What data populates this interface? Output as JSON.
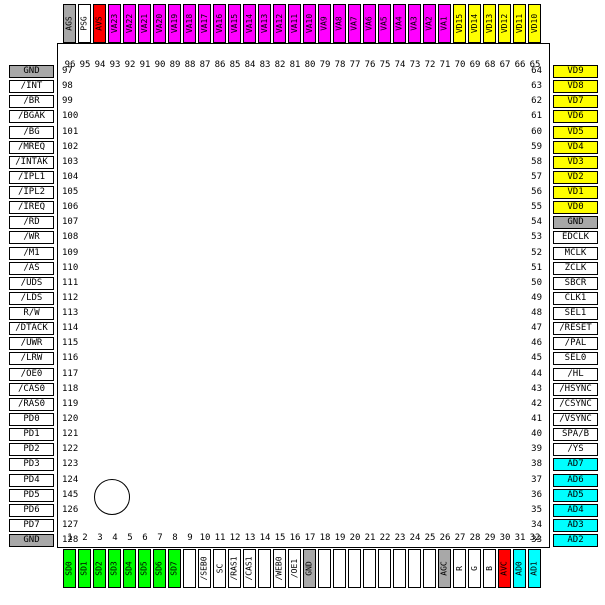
{
  "colors": {
    "gray": "#a8a8a8",
    "white": "#ffffff",
    "red": "#ff0000",
    "magenta": "#ff00ff",
    "yellow": "#ffff00",
    "green": "#00ff00",
    "cyan": "#00ffff"
  },
  "pins": {
    "top": [
      {
        "num": "96",
        "label": "AGS",
        "color": "gray"
      },
      {
        "num": "95",
        "label": "PSG",
        "color": "white"
      },
      {
        "num": "94",
        "label": "AVS",
        "color": "red"
      },
      {
        "num": "93",
        "label": "VA23",
        "color": "magenta"
      },
      {
        "num": "92",
        "label": "VA22",
        "color": "magenta"
      },
      {
        "num": "91",
        "label": "VA21",
        "color": "magenta"
      },
      {
        "num": "90",
        "label": "VA20",
        "color": "magenta"
      },
      {
        "num": "89",
        "label": "VA19",
        "color": "magenta"
      },
      {
        "num": "88",
        "label": "VA18",
        "color": "magenta"
      },
      {
        "num": "87",
        "label": "VA17",
        "color": "magenta"
      },
      {
        "num": "86",
        "label": "VA16",
        "color": "magenta"
      },
      {
        "num": "85",
        "label": "VA15",
        "color": "magenta"
      },
      {
        "num": "84",
        "label": "VA14",
        "color": "magenta"
      },
      {
        "num": "83",
        "label": "VA13",
        "color": "magenta"
      },
      {
        "num": "82",
        "label": "VA12",
        "color": "magenta"
      },
      {
        "num": "81",
        "label": "VA11",
        "color": "magenta"
      },
      {
        "num": "80",
        "label": "VA10",
        "color": "magenta"
      },
      {
        "num": "79",
        "label": "VA9",
        "color": "magenta"
      },
      {
        "num": "78",
        "label": "VA8",
        "color": "magenta"
      },
      {
        "num": "77",
        "label": "VA7",
        "color": "magenta"
      },
      {
        "num": "76",
        "label": "VA6",
        "color": "magenta"
      },
      {
        "num": "75",
        "label": "VA5",
        "color": "magenta"
      },
      {
        "num": "74",
        "label": "VA4",
        "color": "magenta"
      },
      {
        "num": "73",
        "label": "VA3",
        "color": "magenta"
      },
      {
        "num": "72",
        "label": "VA2",
        "color": "magenta"
      },
      {
        "num": "71",
        "label": "VA1",
        "color": "magenta"
      },
      {
        "num": "70",
        "label": "VD15",
        "color": "yellow"
      },
      {
        "num": "69",
        "label": "VD14",
        "color": "yellow"
      },
      {
        "num": "68",
        "label": "VD13",
        "color": "yellow"
      },
      {
        "num": "67",
        "label": "VD12",
        "color": "yellow"
      },
      {
        "num": "66",
        "label": "VD11",
        "color": "yellow"
      },
      {
        "num": "65",
        "label": "VD10",
        "color": "yellow"
      }
    ],
    "left": [
      {
        "num": "97",
        "label": "GND",
        "color": "gray"
      },
      {
        "num": "98",
        "label": "/INT",
        "color": "white"
      },
      {
        "num": "99",
        "label": "/BR",
        "color": "white"
      },
      {
        "num": "100",
        "label": "/BGAK",
        "color": "white"
      },
      {
        "num": "101",
        "label": "/BG",
        "color": "white"
      },
      {
        "num": "102",
        "label": "/MREQ",
        "color": "white"
      },
      {
        "num": "103",
        "label": "/INTAK",
        "color": "white"
      },
      {
        "num": "104",
        "label": "/IPL1",
        "color": "white"
      },
      {
        "num": "105",
        "label": "/IPL2",
        "color": "white"
      },
      {
        "num": "106",
        "label": "/IREQ",
        "color": "white"
      },
      {
        "num": "107",
        "label": "/RD",
        "color": "white"
      },
      {
        "num": "108",
        "label": "/WR",
        "color": "white"
      },
      {
        "num": "109",
        "label": "/M1",
        "color": "white"
      },
      {
        "num": "110",
        "label": "/AS",
        "color": "white"
      },
      {
        "num": "111",
        "label": "/UDS",
        "color": "white"
      },
      {
        "num": "112",
        "label": "/LDS",
        "color": "white"
      },
      {
        "num": "113",
        "label": "R/W",
        "color": "white"
      },
      {
        "num": "114",
        "label": "/DTACK",
        "color": "white"
      },
      {
        "num": "115",
        "label": "/UWR",
        "color": "white"
      },
      {
        "num": "116",
        "label": "/LRW",
        "color": "white"
      },
      {
        "num": "117",
        "label": "/OE0",
        "color": "white"
      },
      {
        "num": "118",
        "label": "/CAS0",
        "color": "white"
      },
      {
        "num": "119",
        "label": "/RAS0",
        "color": "white"
      },
      {
        "num": "120",
        "label": "PD0",
        "color": "white"
      },
      {
        "num": "121",
        "label": "PD1",
        "color": "white"
      },
      {
        "num": "122",
        "label": "PD2",
        "color": "white"
      },
      {
        "num": "123",
        "label": "PD3",
        "color": "white"
      },
      {
        "num": "124",
        "label": "PD4",
        "color": "white"
      },
      {
        "num": "145",
        "label": "PD5",
        "color": "white"
      },
      {
        "num": "126",
        "label": "PD6",
        "color": "white"
      },
      {
        "num": "127",
        "label": "PD7",
        "color": "white"
      },
      {
        "num": "128",
        "label": "GND",
        "color": "gray"
      }
    ],
    "right": [
      {
        "num": "64",
        "label": "VD9",
        "color": "yellow"
      },
      {
        "num": "63",
        "label": "VD8",
        "color": "yellow"
      },
      {
        "num": "62",
        "label": "VD7",
        "color": "yellow"
      },
      {
        "num": "61",
        "label": "VD6",
        "color": "yellow"
      },
      {
        "num": "60",
        "label": "VD5",
        "color": "yellow"
      },
      {
        "num": "59",
        "label": "VD4",
        "color": "yellow"
      },
      {
        "num": "58",
        "label": "VD3",
        "color": "yellow"
      },
      {
        "num": "57",
        "label": "VD2",
        "color": "yellow"
      },
      {
        "num": "56",
        "label": "VD1",
        "color": "yellow"
      },
      {
        "num": "55",
        "label": "VD0",
        "color": "yellow"
      },
      {
        "num": "54",
        "label": "GND",
        "color": "gray"
      },
      {
        "num": "53",
        "label": "EDCLK",
        "color": "white"
      },
      {
        "num": "52",
        "label": "MCLK",
        "color": "white"
      },
      {
        "num": "51",
        "label": "ZCLK",
        "color": "white"
      },
      {
        "num": "50",
        "label": "SBCR",
        "color": "white"
      },
      {
        "num": "49",
        "label": "CLK1",
        "color": "white"
      },
      {
        "num": "48",
        "label": "SEL1",
        "color": "white"
      },
      {
        "num": "47",
        "label": "/RESET",
        "color": "white"
      },
      {
        "num": "46",
        "label": "/PAL",
        "color": "white"
      },
      {
        "num": "45",
        "label": "SEL0",
        "color": "white"
      },
      {
        "num": "44",
        "label": "/HL",
        "color": "white"
      },
      {
        "num": "43",
        "label": "/HSYNC",
        "color": "white"
      },
      {
        "num": "42",
        "label": "/CSYNC",
        "color": "white"
      },
      {
        "num": "41",
        "label": "/VSYNC",
        "color": "white"
      },
      {
        "num": "40",
        "label": "SPA/B",
        "color": "white"
      },
      {
        "num": "39",
        "label": "/YS",
        "color": "white"
      },
      {
        "num": "38",
        "label": "AD7",
        "color": "cyan"
      },
      {
        "num": "37",
        "label": "AD6",
        "color": "cyan"
      },
      {
        "num": "36",
        "label": "AD5",
        "color": "cyan"
      },
      {
        "num": "35",
        "label": "AD4",
        "color": "cyan"
      },
      {
        "num": "34",
        "label": "AD3",
        "color": "cyan"
      },
      {
        "num": "33",
        "label": "AD2",
        "color": "cyan"
      }
    ],
    "bottom": [
      {
        "num": "1",
        "label": "SD0",
        "color": "green"
      },
      {
        "num": "2",
        "label": "SD1",
        "color": "green"
      },
      {
        "num": "3",
        "label": "SD2",
        "color": "green"
      },
      {
        "num": "4",
        "label": "SD3",
        "color": "green"
      },
      {
        "num": "5",
        "label": "SD4",
        "color": "green"
      },
      {
        "num": "6",
        "label": "SD5",
        "color": "green"
      },
      {
        "num": "7",
        "label": "SD6",
        "color": "green"
      },
      {
        "num": "8",
        "label": "SD7",
        "color": "green"
      },
      {
        "num": "9",
        "label": "",
        "color": "white"
      },
      {
        "num": "10",
        "label": "/SEB0",
        "color": "white"
      },
      {
        "num": "11",
        "label": "SC",
        "color": "white"
      },
      {
        "num": "12",
        "label": "/RAS1",
        "color": "white"
      },
      {
        "num": "13",
        "label": "/CAS1",
        "color": "white"
      },
      {
        "num": "14",
        "label": "",
        "color": "white"
      },
      {
        "num": "15",
        "label": "/WEB0",
        "color": "white"
      },
      {
        "num": "16",
        "label": "/OE1",
        "color": "white"
      },
      {
        "num": "17",
        "label": "GND",
        "color": "gray"
      },
      {
        "num": "18",
        "label": "",
        "color": "white"
      },
      {
        "num": "19",
        "label": "",
        "color": "white"
      },
      {
        "num": "20",
        "label": "",
        "color": "white"
      },
      {
        "num": "21",
        "label": "",
        "color": "white"
      },
      {
        "num": "22",
        "label": "",
        "color": "white"
      },
      {
        "num": "23",
        "label": "",
        "color": "white"
      },
      {
        "num": "24",
        "label": "",
        "color": "white"
      },
      {
        "num": "25",
        "label": "",
        "color": "white"
      },
      {
        "num": "26",
        "label": "AGC",
        "color": "gray"
      },
      {
        "num": "27",
        "label": "R",
        "color": "white"
      },
      {
        "num": "28",
        "label": "G",
        "color": "white"
      },
      {
        "num": "29",
        "label": "B",
        "color": "white"
      },
      {
        "num": "30",
        "label": "AVC",
        "color": "red"
      },
      {
        "num": "31",
        "label": "AD0",
        "color": "cyan"
      },
      {
        "num": "32",
        "label": "AD1",
        "color": "cyan"
      }
    ]
  }
}
